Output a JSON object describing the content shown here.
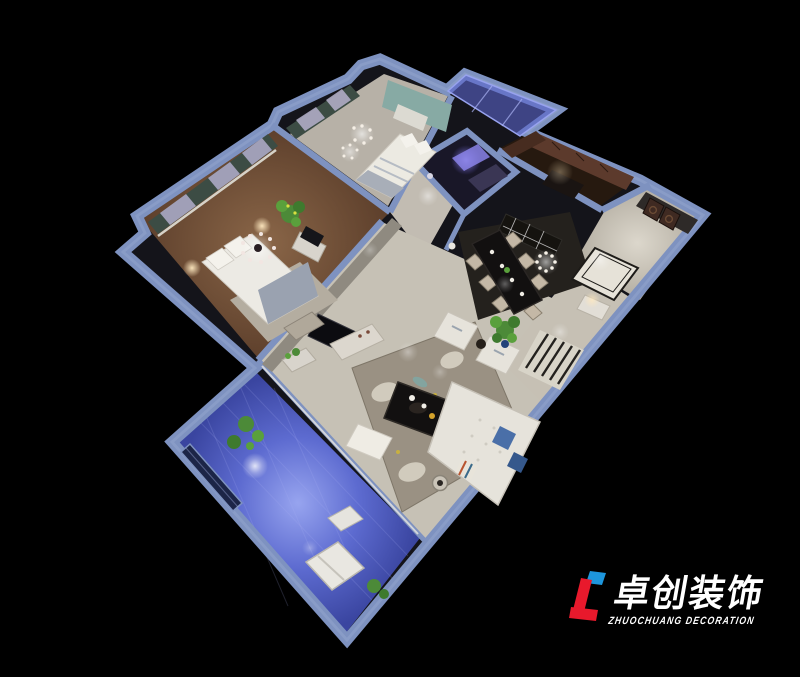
{
  "canvas": {
    "width": 800,
    "height": 677,
    "background": "#000000"
  },
  "scene": {
    "type": "3d-dollhouse-floorplan-render",
    "rooms": [
      "second-bedroom",
      "master-bedroom",
      "bathroom",
      "kitchen",
      "entry-hall",
      "dining-room",
      "living-room",
      "hallway",
      "south-balcony",
      "north-glass-balcony",
      "corridor"
    ]
  },
  "logo": {
    "name": "卓创装饰",
    "tagline": "ZHUOCHUANG DECORATION"
  },
  "colors": {
    "bg": "#000000",
    "wall": "#7e92c0",
    "wallLight": "#93a5cd",
    "marble": "#c9c4ba",
    "marbleBright": "#e8e4da",
    "wood": "#6e4a33",
    "rug": "#9a9183",
    "rugFlower": "#d8d2c4",
    "rugLeaf": "#7fa8a4",
    "balcony": "#4a57b8",
    "balconyLight": "#8d9bec",
    "glass": "#5a64cc",
    "tealWall": "#87aaa4",
    "curtain": "#3c4c44",
    "cabinet": "#5c3a2c",
    "sofa": "#e6e3db",
    "darkFloor": "#121010",
    "plant": "#4c8a38",
    "logoRed": "#e8192c",
    "logoBlue": "#1d96dd",
    "logoText": "#ffffff"
  }
}
